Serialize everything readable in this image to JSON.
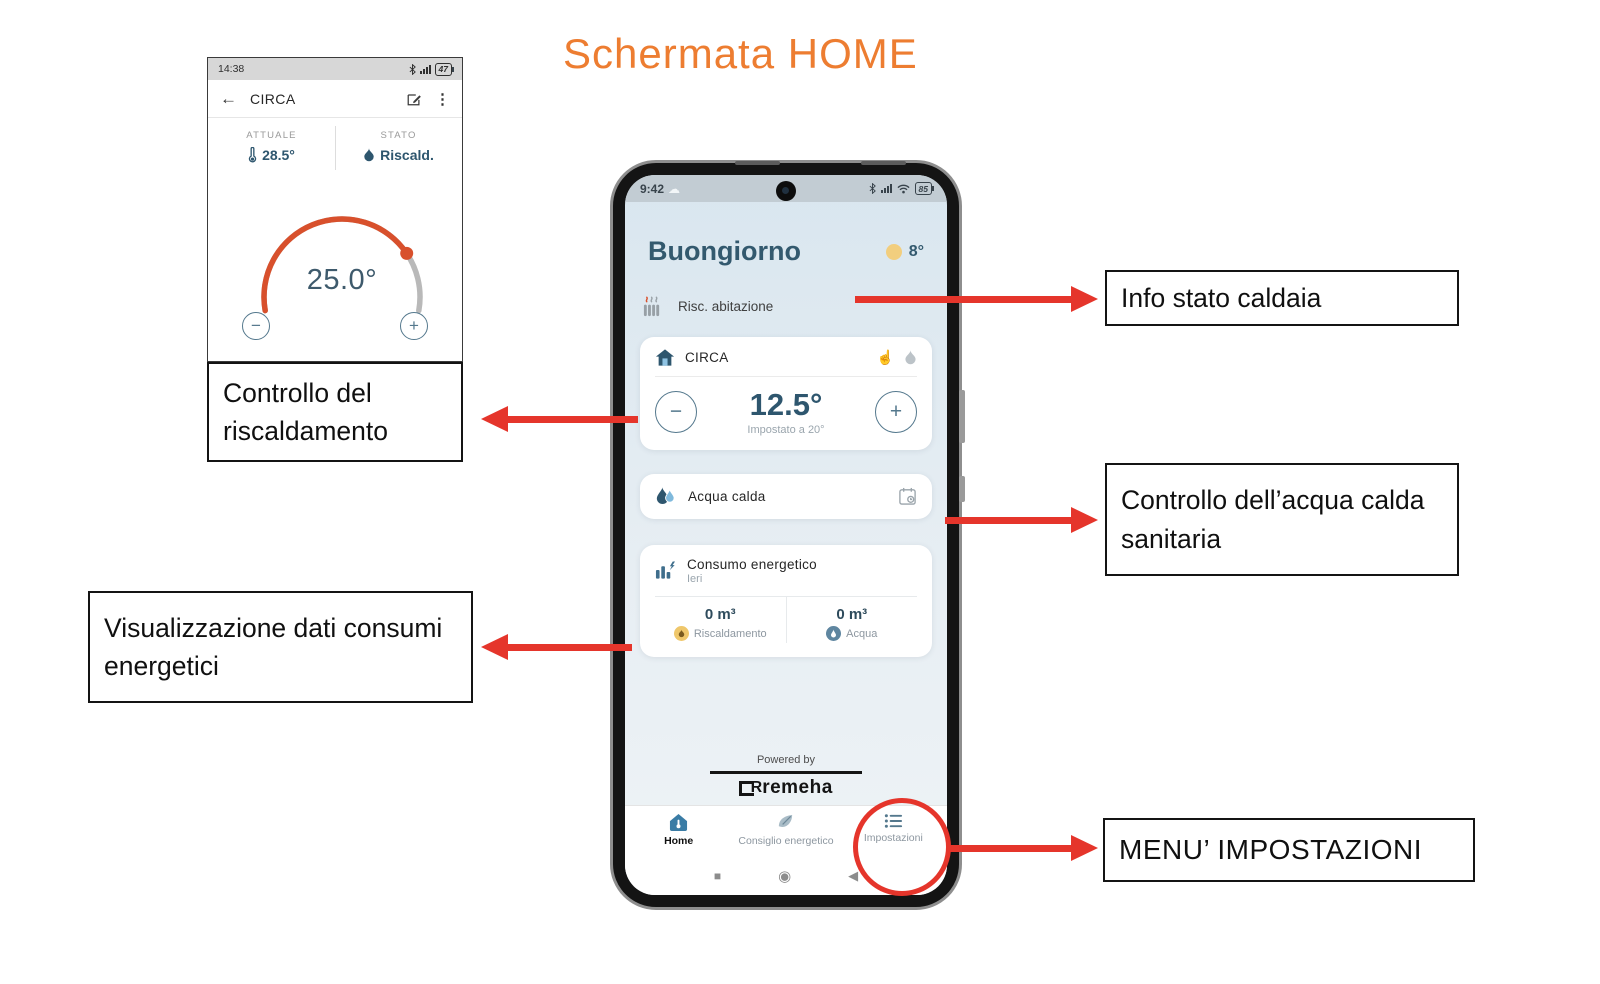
{
  "title": "Schermata HOME",
  "icons": {
    "minus": "−",
    "plus": "+",
    "back": "←",
    "kebab": "⋮",
    "hand": "☝",
    "cloud": "☁",
    "nav_square": "■",
    "nav_circle": "◉",
    "nav_back": "◀"
  },
  "mini": {
    "status_time": "14:38",
    "battery": "47",
    "screen_title": "CIRCA",
    "current_label": "ATTUALE",
    "current_value": "28.5°",
    "state_label": "STATO",
    "state_value": "Riscald.",
    "setpoint": "25.0°"
  },
  "phone": {
    "status_time": "9:42",
    "battery": "85",
    "greeting": "Buongiorno",
    "outdoor_temp": "8°",
    "boiler_status": "Risc. abitazione",
    "zone_card": {
      "name": "CIRCA",
      "temperature": "12.5°",
      "setpoint_note": "Impostato a 20°"
    },
    "dhw_card": {
      "label": "Acqua calda"
    },
    "energy_card": {
      "title": "Consumo energetico",
      "subtitle": "Ieri",
      "heating": {
        "value": "0 m³",
        "label": "Riscaldamento"
      },
      "water": {
        "value": "0 m³",
        "label": "Acqua"
      }
    },
    "powered_by": "Powered by",
    "brand_mark": "R",
    "brand": "remeha",
    "nav": [
      {
        "label": "Home"
      },
      {
        "label": "Consiglio energetico"
      },
      {
        "label": "Impostazioni"
      }
    ]
  },
  "callouts": {
    "info_stato": "Info stato caldaia",
    "controllo_riscaldamento": "Controllo del riscaldamento",
    "controllo_acqua": "Controllo dell’acqua calda sanitaria",
    "visualizzazione": "Visualizzazione dati consumi energetici",
    "menu_impostazioni": "MENU’ IMPOSTAZIONI"
  },
  "colors": {
    "accent_orange": "#ED7D31",
    "annotation_red": "#E5352B",
    "dark_blue": "#2E566E",
    "dial_orange": "#D8502C"
  }
}
